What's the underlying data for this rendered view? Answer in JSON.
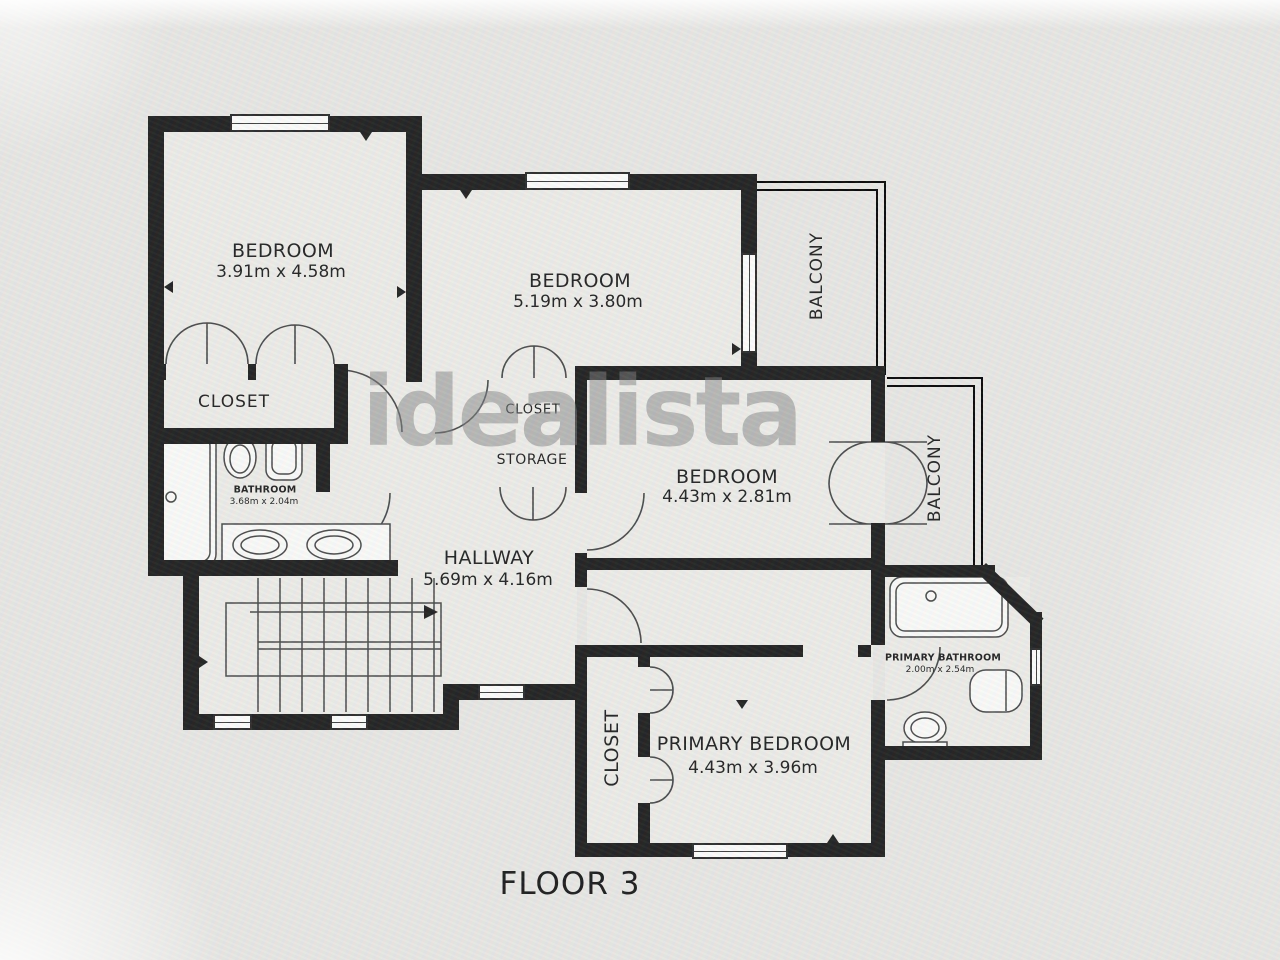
{
  "plan": {
    "floor_label": "FLOOR 3",
    "watermark": "idealista",
    "rooms": {
      "bedroom_top_left": {
        "name": "BEDROOM",
        "dims": "3.91m x 4.58m"
      },
      "bedroom_top_middle": {
        "name": "BEDROOM",
        "dims": "5.19m x 3.80m"
      },
      "bedroom_middle": {
        "name": "BEDROOM",
        "dims": "4.43m x 2.81m"
      },
      "primary_bedroom": {
        "name": "PRIMARY BEDROOM",
        "dims": "4.43m x 3.96m"
      },
      "hallway": {
        "name": "HALLWAY",
        "dims": "5.69m x 4.16m"
      },
      "bathroom": {
        "name": "BATHROOM",
        "dims": "3.68m x 2.04m"
      },
      "primary_bathroom": {
        "name": "PRIMARY BATHROOM",
        "dims": "2.00m x 2.54m"
      }
    },
    "areas": {
      "closet_bedroom1": "CLOSET",
      "closet_hall": "CLOSET",
      "storage": "STORAGE",
      "closet_primary": "CLOSET",
      "balcony_top": "BALCONY",
      "balcony_right": "BALCONY"
    },
    "colors": {
      "wall": "#1b1b1b",
      "floor": "#edece8",
      "background": "#e8e7e4",
      "thin_line": "#454545",
      "watermark_gray": "#7d7d7d"
    }
  }
}
